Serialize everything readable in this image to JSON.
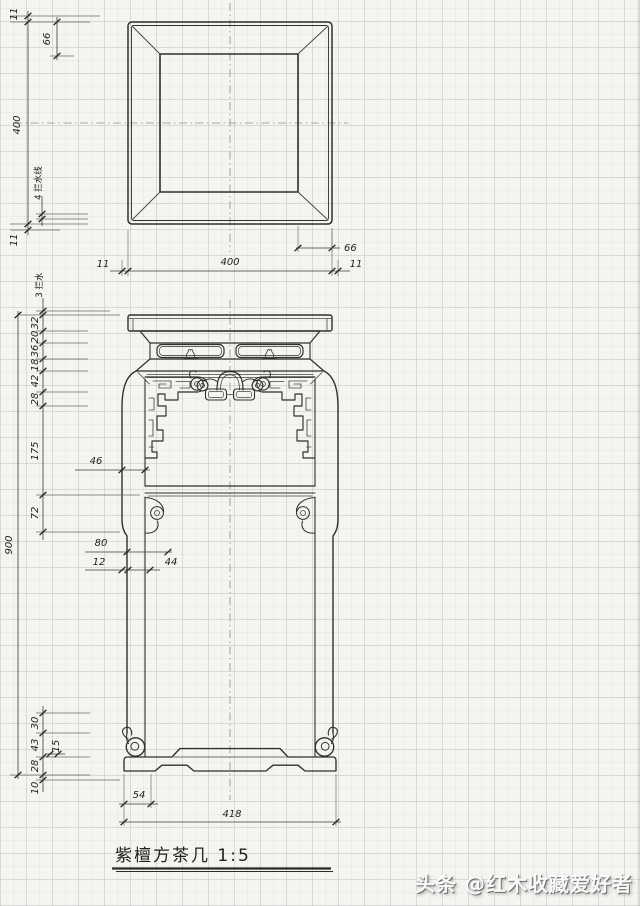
{
  "colors": {
    "ink": "#2f2f2f",
    "paper": "#f5f4f1"
  },
  "title_block": {
    "title": "紫檀方茶几 1:5"
  },
  "watermark": {
    "text": "头条 @红木收藏爱好者"
  },
  "top_view": {
    "dims": {
      "margin_top_11": "11",
      "border_66": "66",
      "height_400": "400",
      "note": "4 拦水线",
      "margin_bottom_11": "11",
      "right_66": "66",
      "bottom_left_11": "11",
      "bottom_400": "400",
      "bottom_right_11": "11"
    }
  },
  "front_view": {
    "dims": {
      "note": "3 拦水",
      "s32": "32",
      "s20": "20",
      "s36": "36",
      "s18": "18",
      "s42": "42",
      "s28": "28",
      "s175": "175",
      "s72": "72",
      "h900": "900",
      "w46": "46",
      "w80": "80",
      "w12": "12",
      "w44": "44",
      "f30": "30",
      "f43": "43",
      "f28": "28",
      "f10": "10",
      "f15": "15",
      "pad54": "54",
      "base418": "418"
    }
  }
}
